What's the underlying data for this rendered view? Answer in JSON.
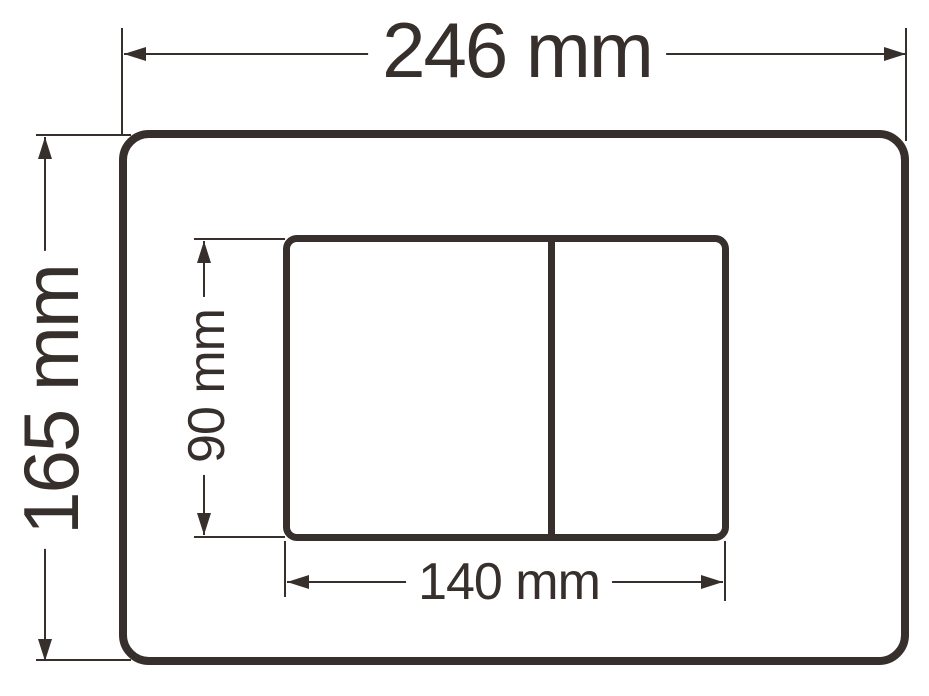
{
  "diagram": {
    "background": "#ffffff",
    "line_color": "#362f2c",
    "labels": {
      "outer_width": "246 mm",
      "outer_height": "165 mm",
      "inner_height": "90 mm",
      "inner_width": "140 mm"
    },
    "values_mm": {
      "outer_width": 246,
      "outer_height": 165,
      "inner_width": 140,
      "inner_height": 90
    }
  }
}
